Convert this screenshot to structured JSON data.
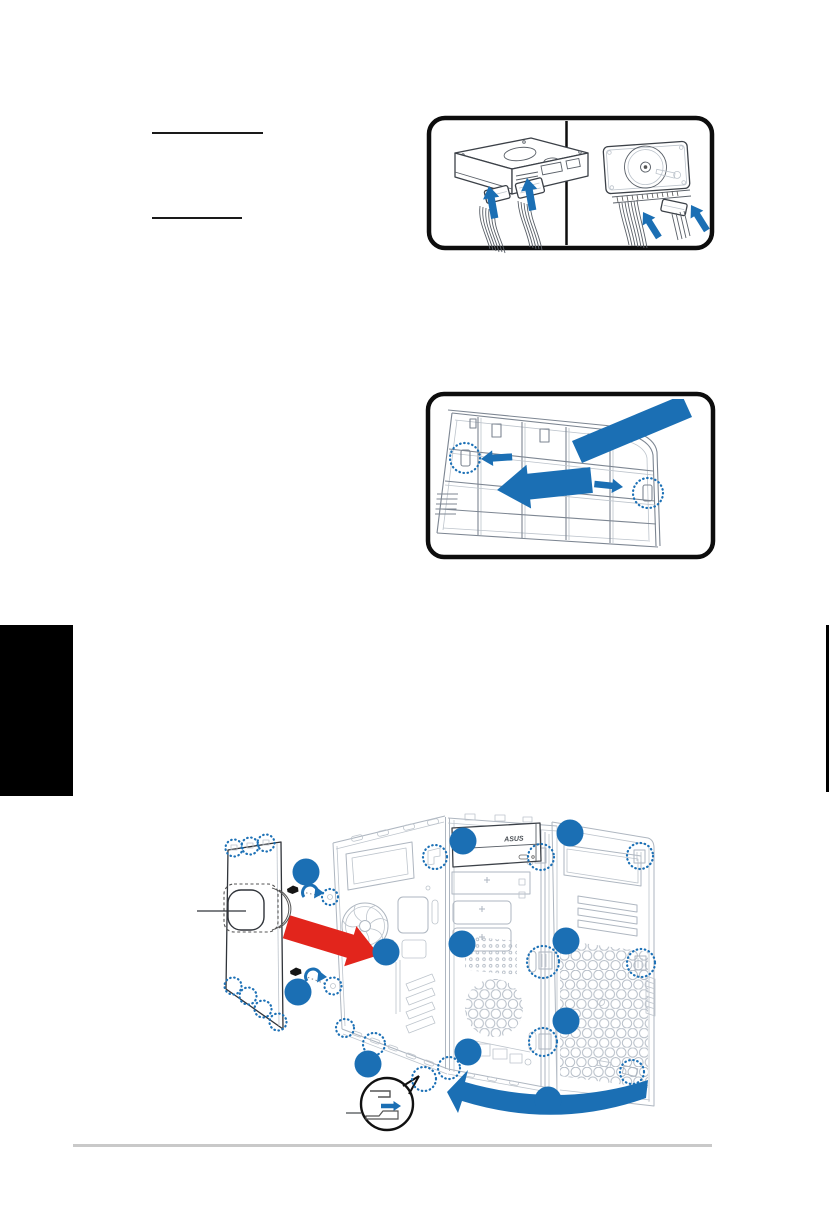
{
  "colors": {
    "accent_blue": "#1b6fb4",
    "arrow_red": "#e2251c",
    "artwork_line_light": "#aeb6c0",
    "artwork_line_dark": "#3c4148",
    "frame_border": "#0d0d0d",
    "footer_rule": "#c9c9c9",
    "chapter_tab": "#000000"
  },
  "text": {
    "optical_drive_brand": "ASUS"
  },
  "layout_marks": {
    "heading_underline_count": 2,
    "chapter_tab": true,
    "page_edge_mark": true,
    "footer_rule": true
  },
  "figures": {
    "hdd_connections": {
      "panels": [
        {
          "icon": "hdd-front-3d-view",
          "blue_arrows": 2
        },
        {
          "icon": "hdd-top-view",
          "blue_arrows": 2
        }
      ]
    },
    "front_bezel_removal": {
      "hook_highlights": 2,
      "blue_arrows": 4
    },
    "chassis_assembly": {
      "optical_drive_brand": "ASUS",
      "callout_dots": 11,
      "thumbscrews": 2,
      "dashed_highlights": 20,
      "red_insert_arrow": 1,
      "blue_swing_arrow": 1,
      "magnifier_inset": 1
    }
  }
}
